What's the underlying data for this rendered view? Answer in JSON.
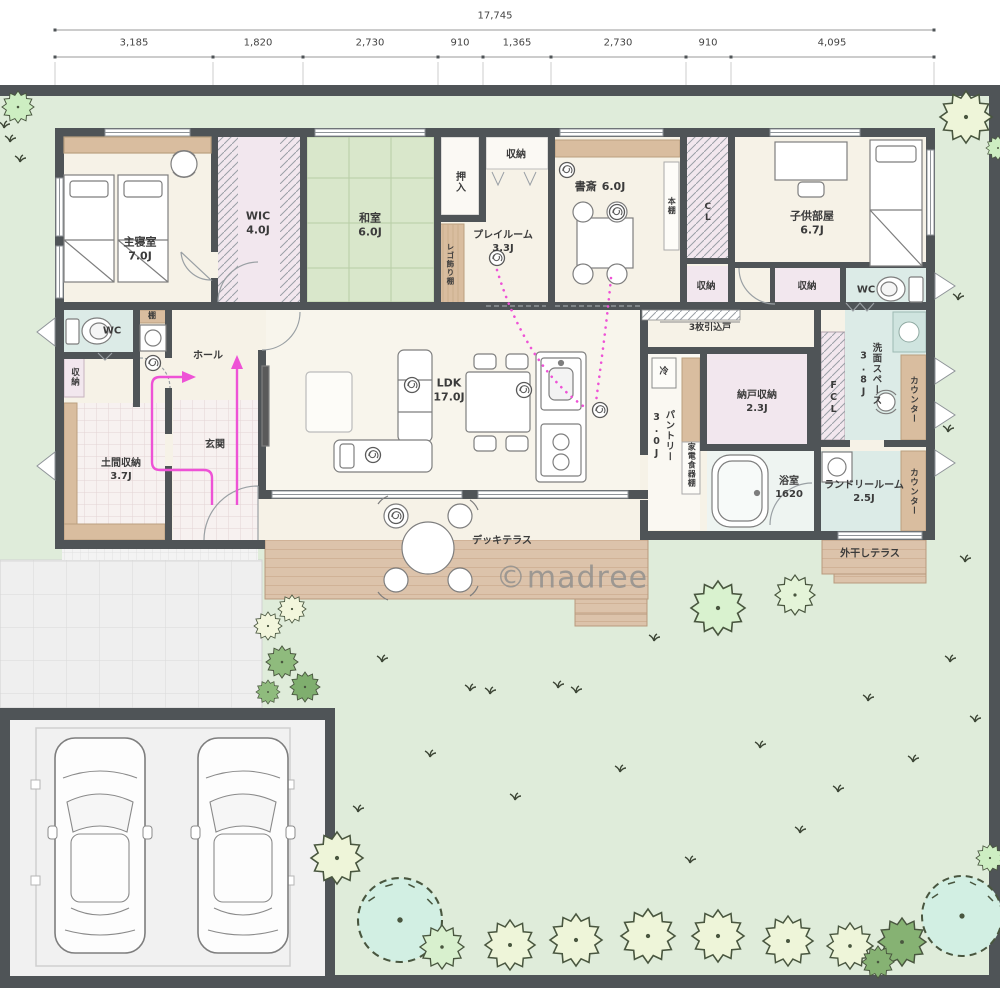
{
  "watermark": "©madree",
  "dimensions": {
    "total": "17,745",
    "segments": [
      "3,185",
      "1,820",
      "2,730",
      "910",
      "1,365",
      "2,730",
      "910",
      "4,095"
    ]
  },
  "rooms": {
    "master": {
      "name": "主寝室",
      "size": "7.0J"
    },
    "wic": {
      "name": "WIC",
      "size": "4.0J"
    },
    "washitsu": {
      "name": "和室",
      "size": "6.0J"
    },
    "oshiire": {
      "name": "押入"
    },
    "closet": {
      "name": "収納"
    },
    "playroom": {
      "name": "プレイルーム",
      "size": "3.3J"
    },
    "study": {
      "name": "書斎",
      "size": "6.0J"
    },
    "bookshelf": {
      "name": "本棚"
    },
    "cl": {
      "name": "CL"
    },
    "kids": {
      "name": "子供部屋",
      "size": "6.7J"
    },
    "wc": {
      "name": "WC"
    },
    "shelf": {
      "name": "棚"
    },
    "hall": {
      "name": "ホール"
    },
    "genkan": {
      "name": "玄関"
    },
    "doma": {
      "name": "土間収納",
      "size": "3.7J"
    },
    "ldk": {
      "name": "LDK",
      "size": "17.0J"
    },
    "sliding3": {
      "name": "3枚引込戸"
    },
    "fridge": {
      "name": "冷"
    },
    "pantry": {
      "name": "パントリー",
      "size": "3.0J"
    },
    "applianceShelf": {
      "name": "家電食器棚"
    },
    "nando": {
      "name": "納戸収納",
      "size": "2.3J"
    },
    "fcl": {
      "name": "FCL"
    },
    "senmen": {
      "name": "洗面スペース",
      "size": "3.8J"
    },
    "counter": {
      "name": "カウンター"
    },
    "bath": {
      "name": "浴室",
      "size": "1620"
    },
    "laundry": {
      "name": "ランドリールーム",
      "size": "2.5J"
    },
    "drying": {
      "name": "外干しテラス"
    },
    "deck": {
      "name": "デッキテラス"
    },
    "lego": {
      "name": "レゴ飾り棚"
    }
  }
}
